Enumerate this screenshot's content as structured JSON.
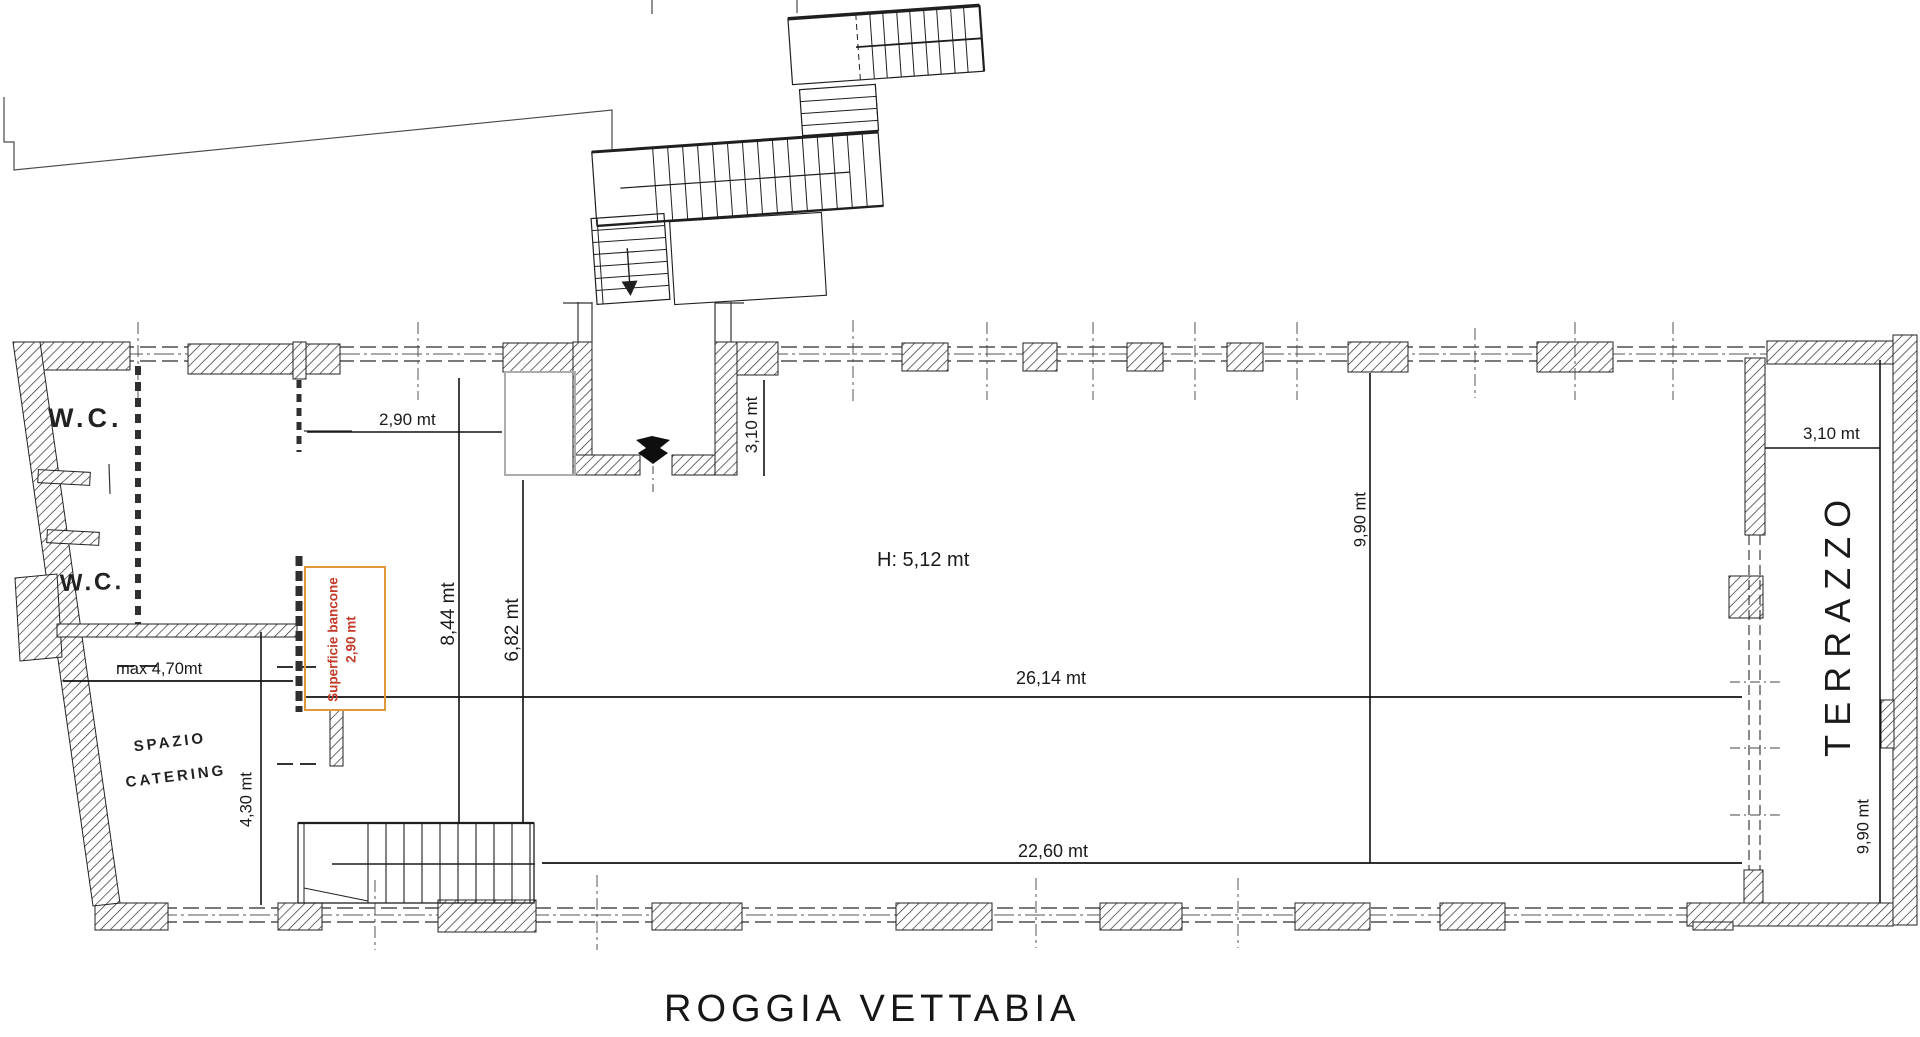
{
  "plan": {
    "labels": {
      "wc_1": "W.C.",
      "wc_2": "W.C.",
      "spazio": "SPAZIO",
      "catering": "CATERING",
      "terrazzo": "TERRAZZO",
      "height": "H: 5,12 mt",
      "caption": "ROGGIA VETTABIA"
    },
    "bancone": {
      "line1": "Superficie bancone",
      "line2": "2,90 mt"
    },
    "dimensions": {
      "opening_top": "2,90 mt",
      "entrance_depth": "3,10 mt",
      "left_span": "8,44 mt",
      "inner_span": "6,82 mt",
      "hall_length": "26,14 mt",
      "hall_length_lower": "22,60 mt",
      "catering_max_width": "max 4,70mt",
      "catering_depth": "4,30 mt",
      "hall_depth": "9,90 mt",
      "terrazzo_width": "3,10 mt",
      "terrazzo_depth": "9,90 mt"
    },
    "colors": {
      "ink": "#1a1a1a",
      "bancone_box": "#E2973B",
      "bancone_text": "#C23B2A",
      "room_outline_gray": "#ADADAD"
    }
  }
}
